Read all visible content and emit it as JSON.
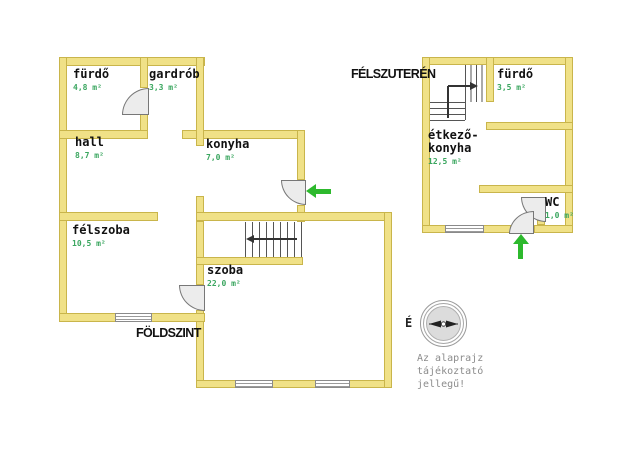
{
  "colors": {
    "wall_fill": "#f0e187",
    "wall_border": "#c9b54b",
    "area_text": "#3aa65f",
    "arrow_green": "#2db92d"
  },
  "ground_floor": {
    "title": "FÖLDSZINT",
    "rooms": [
      {
        "name": "fürdő",
        "area": "4,8 m²"
      },
      {
        "name": "gardrób",
        "area": "3,3 m²"
      },
      {
        "name": "hall",
        "area": "8,7 m²"
      },
      {
        "name": "konyha",
        "area": "7,0 m²"
      },
      {
        "name": "félszoba",
        "area": "10,5 m²"
      },
      {
        "name": "szoba",
        "area": "22,0 m²"
      }
    ]
  },
  "basement": {
    "title": "FÉLSZUTERÉN",
    "rooms": [
      {
        "name": "fürdő",
        "area": "3,5 m²"
      },
      {
        "name": "étkező-konyha",
        "area": "12,5 m²"
      },
      {
        "name": "WC",
        "area": "1,0 m²"
      }
    ]
  },
  "compass": {
    "north_label": "É"
  },
  "disclaimer": {
    "line1": "Az alaprajz",
    "line2": "tájékoztató",
    "line3": "jellegű!"
  }
}
